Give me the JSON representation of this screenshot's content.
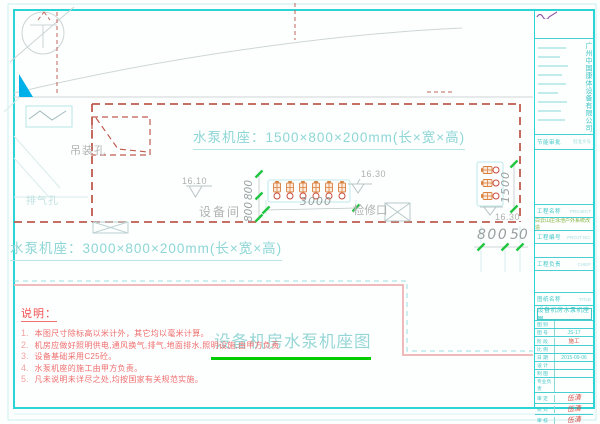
{
  "sheet": {
    "frame_color": "#2bd5d5",
    "dashed_wall_color": "#bf5b4f",
    "accent_green": "#00cc00",
    "note_red": "#ee5150",
    "pump_orange": "#d9813f"
  },
  "drawing": {
    "spec_top": "水泵机座：1500×800×200mm(长×宽×高)",
    "spec_left": "水泵机座：3000×800×200mm(长×宽×高)",
    "label_hoist_hole": "吊装孔",
    "label_vent_hole": "排气孔",
    "label_equipment_room": "设备间",
    "label_access_hatch": "检修口",
    "level_left": "16.10",
    "level_mid": "16.30",
    "level_right": "16.30",
    "dim_row_length": "3000",
    "dim_depth_a": "800",
    "dim_depth_b": "800",
    "dim_side_length": "1500",
    "dim_bottom_a": "800",
    "dim_bottom_b": "50",
    "caption": "设备机房水泵机座图"
  },
  "notes": {
    "heading": "说明：",
    "items": [
      {
        "num": "1.",
        "text": "本图尺寸除标高以米计外，其它均以毫米计算。"
      },
      {
        "num": "2.",
        "text": "机房应做好照明供电,通风换气,排气,地面排水,照明设施,由甲方负责"
      },
      {
        "num": "3.",
        "text": "设备基础采用C25砼。"
      },
      {
        "num": "4.",
        "text": "水泵机座的施工由甲方负责。"
      },
      {
        "num": "5.",
        "text": "凡未说明未详尽之处,均按国家有关规范实施。"
      }
    ]
  },
  "titleblock": {
    "company": "广州中国康体设备有限公司",
    "energy_label": "节能审批",
    "energy_value": "批准文号",
    "project_label": "工程名称",
    "project_label_en": "PROJECT",
    "project_name": "白云山庄泳池户外系统改造",
    "project_no_label": "工程编号",
    "project_no_en": "PROJT NO.",
    "chief_label": "工程负责",
    "chief_en": "CHIEF",
    "sheet_label": "图纸名称",
    "sheet_en": "TITLE",
    "drawing_title": "设备机房水泵机座图",
    "rows": [
      {
        "label": "图 别",
        "value": ""
      },
      {
        "label": "图 号",
        "value": "JS-17"
      },
      {
        "label": "阶 段",
        "value": "施工"
      },
      {
        "label": "比 例",
        "value": ""
      },
      {
        "label": "日 期",
        "value": "2015-09-06"
      },
      {
        "label": "设 计",
        "value": ""
      },
      {
        "label": "制 图",
        "value": ""
      },
      {
        "label": "专业负责",
        "value": ""
      },
      {
        "label": "审 定",
        "value": "伍清"
      },
      {
        "label": "校 对",
        "value": "伍清"
      },
      {
        "label": "审 核",
        "value": "伍清"
      },
      {
        "label": "会 签",
        "value": ""
      }
    ]
  }
}
